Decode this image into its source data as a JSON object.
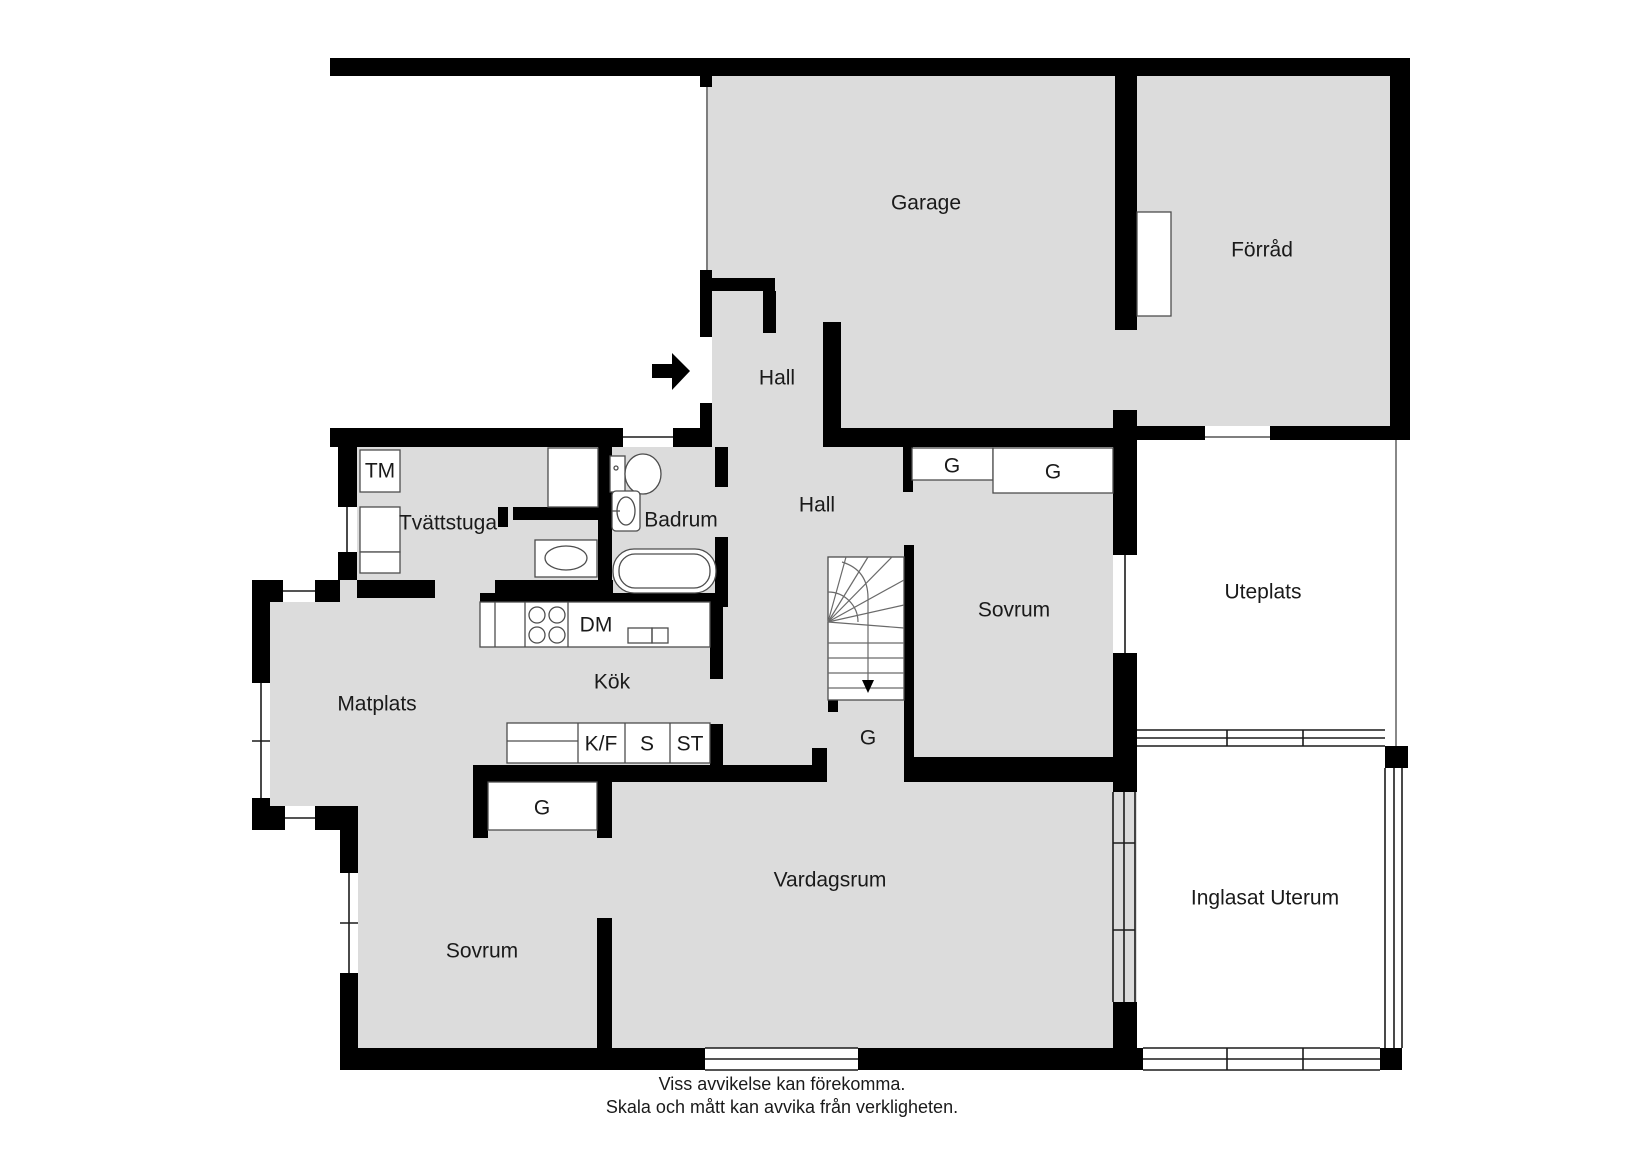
{
  "plan": {
    "rooms": {
      "garage": "Garage",
      "forrad": "Förråd",
      "hall_upper": "Hall",
      "hall_lower": "Hall",
      "tvattstuga": "Tvättstuga",
      "badrum": "Badrum",
      "sovrum_right": "Sovrum",
      "sovrum_left": "Sovrum",
      "matplats": "Matplats",
      "kok": "Kök",
      "vardagsrum": "Vardagsrum",
      "uteplats": "Uteplats",
      "inglasat_uterum": "Inglasat Uterum"
    },
    "fixtures": {
      "tm": "TM",
      "dm": "DM",
      "kf": "K/F",
      "s": "S",
      "st": "ST",
      "g": "G"
    },
    "disclaimer": {
      "line1": "Viss avvikelse kan förekomma.",
      "line2": "Skala och mått kan avvika från verkligheten."
    },
    "colors": {
      "floor": "#dcdcdc",
      "wall": "#000000",
      "background": "#ffffff",
      "fixture_outline": "#4d4d4d",
      "text": "#1a1a1a"
    }
  }
}
